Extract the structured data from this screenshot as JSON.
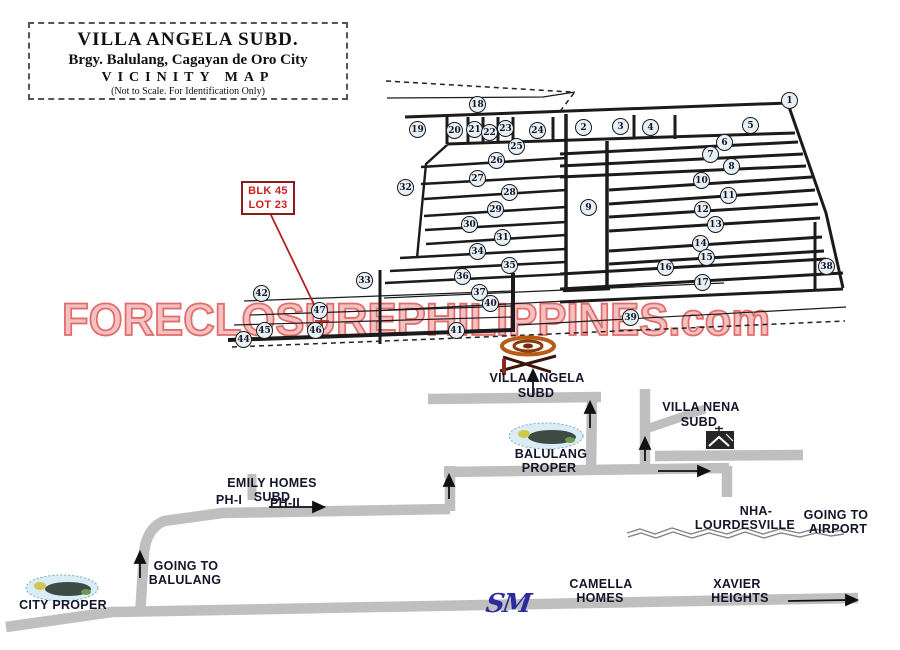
{
  "title_box": {
    "title": "VILLA ANGELA SUBD.",
    "subtitle": "Brgy. Balulang, Cagayan de Oro City",
    "map_type": "VICINITY MAP",
    "note": "(Not  to Scale. For Identification Only)"
  },
  "lot_callout": {
    "block": "BLK 45",
    "lot": "LOT 23"
  },
  "watermark": {
    "text": "FORECLOSUREPHILIPPINES.com",
    "fill": "#f4bcbc",
    "stroke": "#e06060"
  },
  "sm_logo": {
    "text": "SM",
    "color": "#2b2b9b"
  },
  "markers": [
    {
      "n": "1",
      "x": 790,
      "y": 101
    },
    {
      "n": "2",
      "x": 584,
      "y": 128
    },
    {
      "n": "3",
      "x": 621,
      "y": 127
    },
    {
      "n": "4",
      "x": 651,
      "y": 128
    },
    {
      "n": "5",
      "x": 751,
      "y": 126
    },
    {
      "n": "6",
      "x": 725,
      "y": 143
    },
    {
      "n": "7",
      "x": 711,
      "y": 155
    },
    {
      "n": "8",
      "x": 732,
      "y": 167
    },
    {
      "n": "9",
      "x": 589,
      "y": 208
    },
    {
      "n": "10",
      "x": 702,
      "y": 181
    },
    {
      "n": "11",
      "x": 729,
      "y": 196
    },
    {
      "n": "12",
      "x": 703,
      "y": 210
    },
    {
      "n": "13",
      "x": 716,
      "y": 225
    },
    {
      "n": "14",
      "x": 701,
      "y": 244
    },
    {
      "n": "15",
      "x": 707,
      "y": 258
    },
    {
      "n": "16",
      "x": 666,
      "y": 268
    },
    {
      "n": "17",
      "x": 703,
      "y": 283
    },
    {
      "n": "18",
      "x": 478,
      "y": 105
    },
    {
      "n": "19",
      "x": 418,
      "y": 130
    },
    {
      "n": "20",
      "x": 455,
      "y": 131
    },
    {
      "n": "21",
      "x": 475,
      "y": 130
    },
    {
      "n": "22",
      "x": 490,
      "y": 133
    },
    {
      "n": "23",
      "x": 506,
      "y": 129
    },
    {
      "n": "24",
      "x": 538,
      "y": 131
    },
    {
      "n": "25",
      "x": 517,
      "y": 147
    },
    {
      "n": "26",
      "x": 497,
      "y": 161
    },
    {
      "n": "27",
      "x": 478,
      "y": 179
    },
    {
      "n": "28",
      "x": 510,
      "y": 193
    },
    {
      "n": "29",
      "x": 496,
      "y": 210
    },
    {
      "n": "30",
      "x": 470,
      "y": 225
    },
    {
      "n": "31",
      "x": 503,
      "y": 238
    },
    {
      "n": "32",
      "x": 406,
      "y": 188
    },
    {
      "n": "33",
      "x": 365,
      "y": 281
    },
    {
      "n": "34",
      "x": 478,
      "y": 252
    },
    {
      "n": "35",
      "x": 510,
      "y": 266
    },
    {
      "n": "36",
      "x": 463,
      "y": 277
    },
    {
      "n": "37",
      "x": 480,
      "y": 293
    },
    {
      "n": "38",
      "x": 827,
      "y": 267
    },
    {
      "n": "39",
      "x": 631,
      "y": 318
    },
    {
      "n": "40",
      "x": 491,
      "y": 304
    },
    {
      "n": "41",
      "x": 457,
      "y": 331
    },
    {
      "n": "42",
      "x": 262,
      "y": 294
    },
    {
      "n": "44",
      "x": 244,
      "y": 340
    },
    {
      "n": "45",
      "x": 265,
      "y": 331
    },
    {
      "n": "46",
      "x": 316,
      "y": 331
    },
    {
      "n": "47",
      "x": 320,
      "y": 311
    }
  ],
  "labels": [
    {
      "id": "villa-angela-subd-1",
      "text": "VILLA ANGELA",
      "x": 537,
      "y": 371
    },
    {
      "id": "villa-angela-subd-2",
      "text": "SUBD",
      "x": 536,
      "y": 386
    },
    {
      "id": "balulang-proper-1",
      "text": "BALULANG",
      "x": 551,
      "y": 447
    },
    {
      "id": "balulang-proper-2",
      "text": "PROPER",
      "x": 549,
      "y": 461
    },
    {
      "id": "villa-nena-subd-1",
      "text": "VILLA NENA",
      "x": 701,
      "y": 400
    },
    {
      "id": "villa-nena-subd-2",
      "text": "SUBD",
      "x": 699,
      "y": 415
    },
    {
      "id": "emily-homes-subd-1",
      "text": "EMILY HOMES",
      "x": 272,
      "y": 476
    },
    {
      "id": "emily-homes-subd-2",
      "text": "SUBD",
      "x": 272,
      "y": 490
    },
    {
      "id": "ph-1",
      "text": "PH-I",
      "x": 229,
      "y": 493
    },
    {
      "id": "ph-2",
      "text": "PH-II",
      "x": 285,
      "y": 496
    },
    {
      "id": "nha-lourdesville-1",
      "text": "NHA-",
      "x": 756,
      "y": 504
    },
    {
      "id": "nha-lourdesville-2",
      "text": "LOURDESVILLE",
      "x": 745,
      "y": 518
    },
    {
      "id": "going-to-airport-1",
      "text": "GOING TO",
      "x": 836,
      "y": 508
    },
    {
      "id": "going-to-airport-2",
      "text": "AIRPORT",
      "x": 838,
      "y": 522
    },
    {
      "id": "going-to-balulang-1",
      "text": "GOING TO",
      "x": 186,
      "y": 559
    },
    {
      "id": "going-to-balulang-2",
      "text": "BALULANG",
      "x": 185,
      "y": 573
    },
    {
      "id": "city-proper",
      "text": "CITY PROPER",
      "x": 63,
      "y": 598
    },
    {
      "id": "camella-homes-1",
      "text": "CAMELLA",
      "x": 601,
      "y": 577
    },
    {
      "id": "camella-homes-2",
      "text": "HOMES",
      "x": 600,
      "y": 591
    },
    {
      "id": "xavier-heights-1",
      "text": "XAVIER",
      "x": 737,
      "y": 577
    },
    {
      "id": "xavier-heights-2",
      "text": "HEIGHTS",
      "x": 740,
      "y": 591
    }
  ]
}
